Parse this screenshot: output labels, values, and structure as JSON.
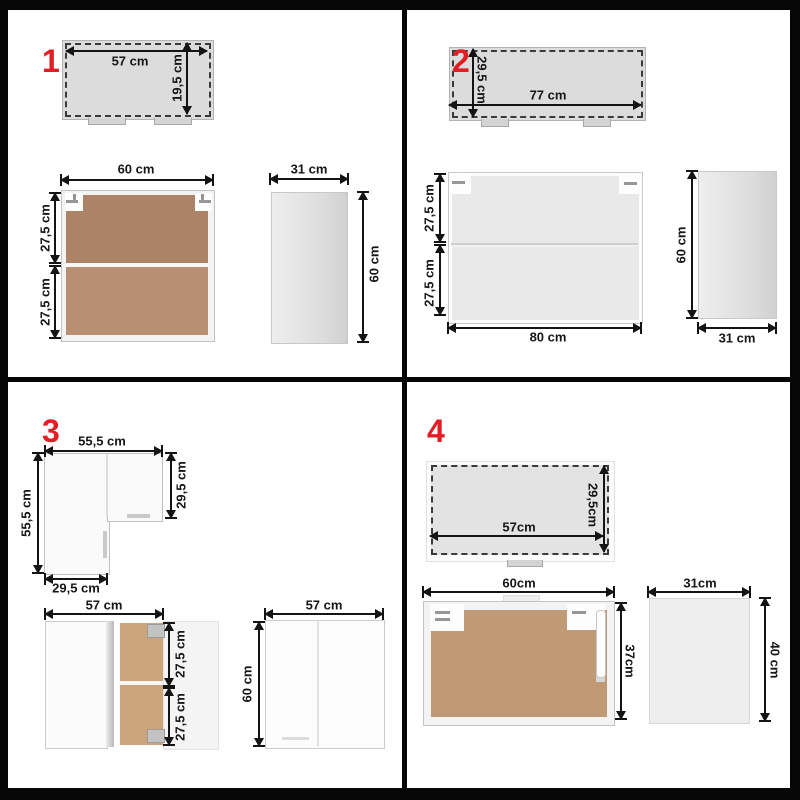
{
  "title": "Kitchen wall cabinet set dimension diagrams",
  "colors": {
    "accent_red": "#e21d24",
    "dimension_line": "#141414",
    "top_view_fill": "#dcdcdc",
    "wood_dark": "#ac8366",
    "wood_medium": "#b98f73",
    "wood_light": "#cba47c",
    "wood_sand": "#c09a74",
    "glass_fill": "#e9e9e9",
    "frame_black": "#060606"
  },
  "panels": {
    "p1": {
      "number": "1",
      "top_view": {
        "width": "57 cm",
        "depth": "19,5 cm"
      },
      "front_view": {
        "width": "60 cm",
        "upper_height": "27,5 cm",
        "lower_height": "27,5 cm"
      },
      "side_view": {
        "width": "31 cm",
        "height": "60 cm"
      }
    },
    "p2": {
      "number": "2",
      "top_view": {
        "depth": "29,5 cm",
        "width": "77 cm"
      },
      "front_view": {
        "upper_height": "27,5 cm",
        "lower_height": "27,5 cm",
        "width": "80 cm"
      },
      "side_view": {
        "height": "60 cm",
        "width": "31 cm"
      }
    },
    "p3": {
      "number": "3",
      "corner_top_view": {
        "top_width": "55,5 cm",
        "left_depth": "55,5 cm",
        "right_depth": "29,5 cm",
        "bottom_width": "29,5 cm"
      },
      "open_cabinet": {
        "width": "57 cm",
        "upper_height": "27,5 cm",
        "lower_height": "27,5 cm"
      },
      "closed_cabinet": {
        "width": "57 cm",
        "height": "60 cm"
      }
    },
    "p4": {
      "number": "4",
      "top_view": {
        "width": "57cm",
        "depth": "29,5cm"
      },
      "front_view": {
        "width": "60cm",
        "height": "37cm"
      },
      "side_view": {
        "width": "31cm",
        "height": "40 cm"
      }
    }
  }
}
